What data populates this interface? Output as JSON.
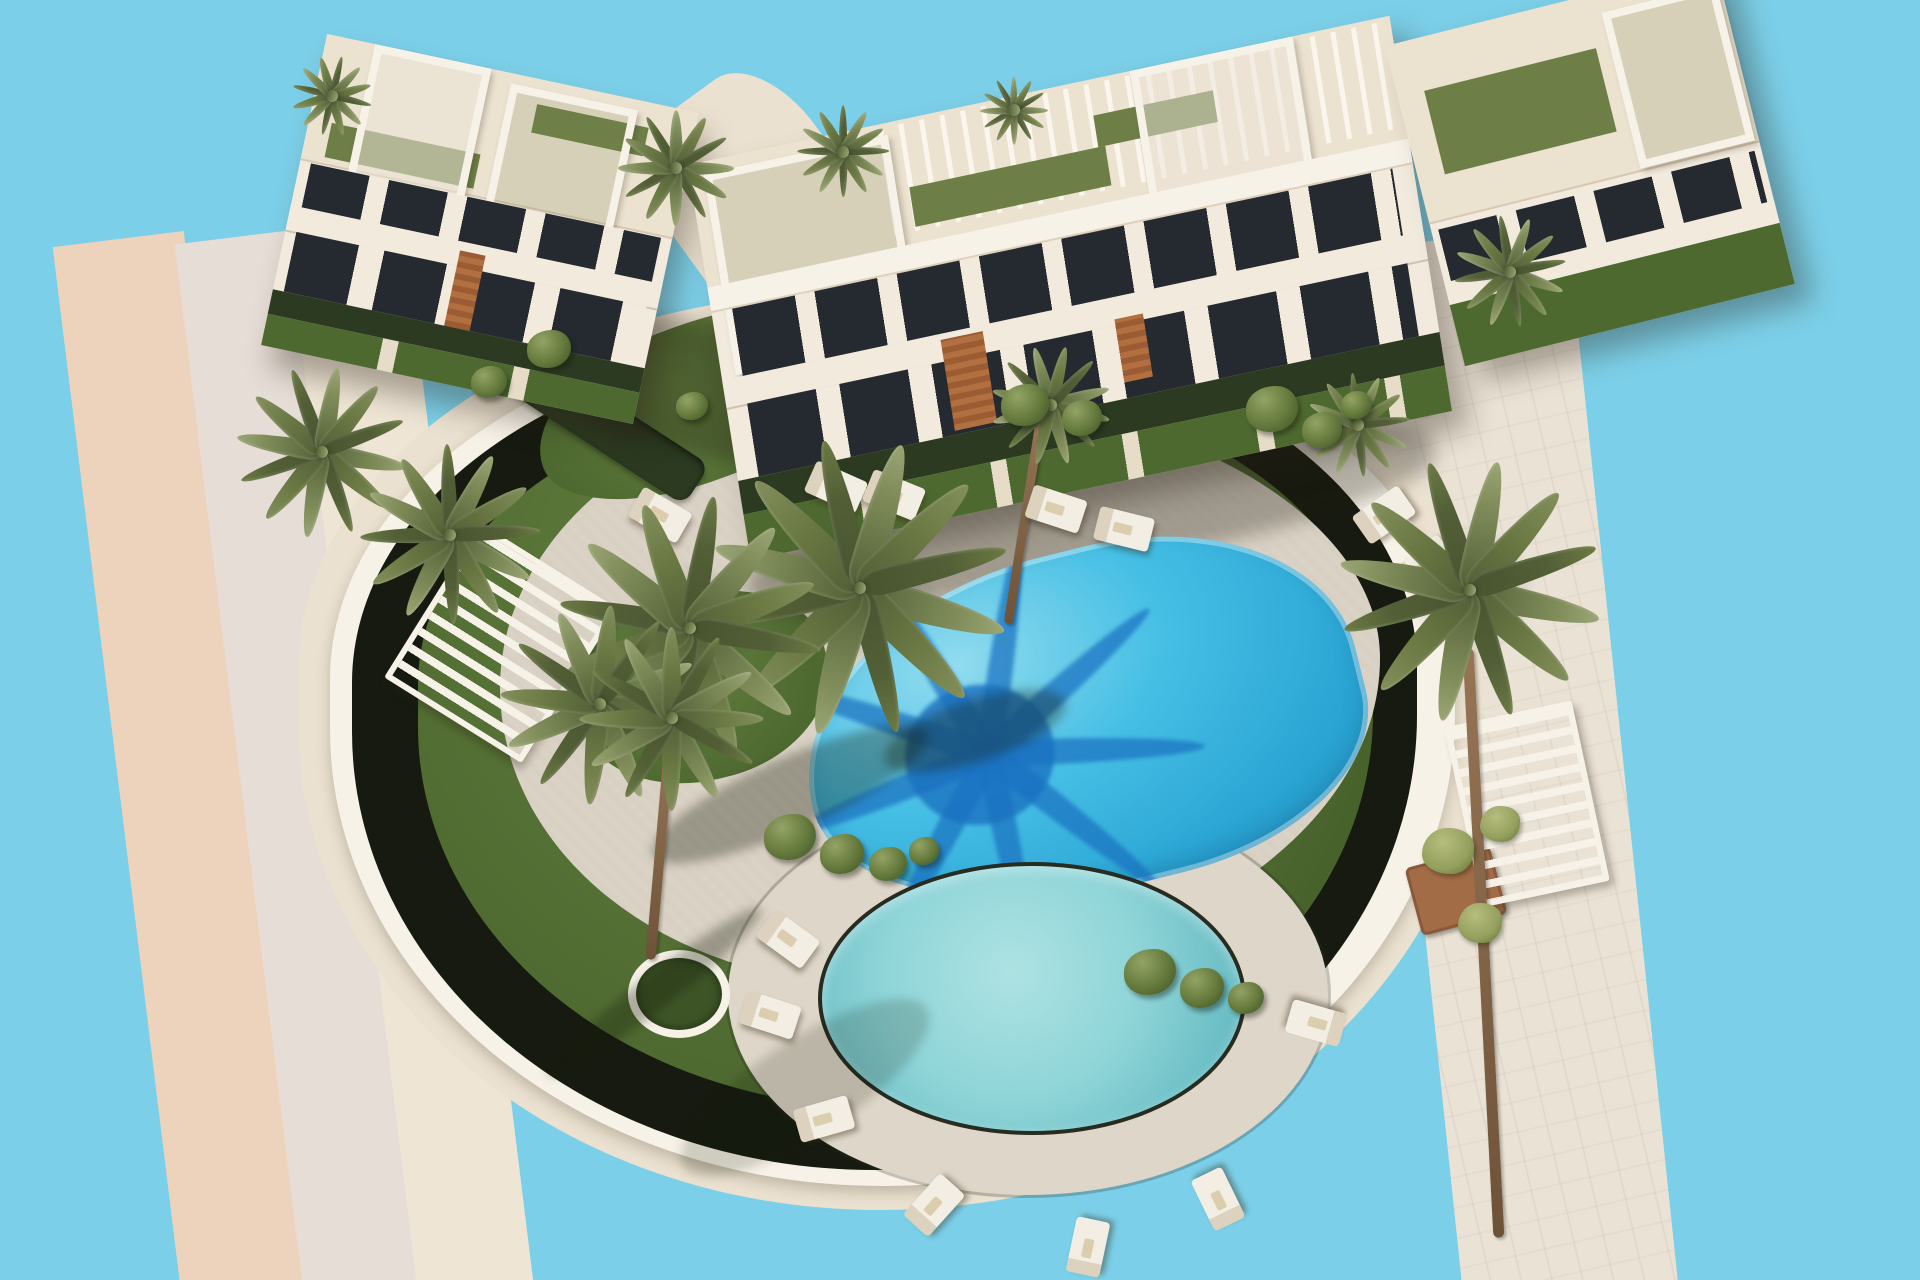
{
  "meta": {
    "width": 1920,
    "height": 1280,
    "alt": "Aerial 3D architectural rendering of a modern white residential complex with two swimming pools, palm trees, lawns, sun loungers and surrounding roads on a plain sky-blue background"
  },
  "palette": {
    "sky": "#7ccfe8",
    "roadPink": "#eed3bc",
    "roadGray": "#e6ddd6",
    "roadCream": "#eee5d5",
    "roadStone": "#eae2d5",
    "apron": "#ebe1d0",
    "wall": "#f7f2e8",
    "hedge": "#161a10",
    "lawnA": "#64803f",
    "lawnB": "#4e6930",
    "lawnC": "#3d5526",
    "deck": "#d8d0c2",
    "deckLight": "#ded6c8",
    "waterALight": "#93dcee",
    "waterA": "#46bfe5",
    "waterADeep": "#2aa5d4",
    "waterShadow": "#1a72c0",
    "waterBLight": "#aee2e3",
    "waterB": "#8fd5d8",
    "waterBDeep": "#68bcc4",
    "coping": "#272b20",
    "trunk": "#967555",
    "frondA": "#6b7944",
    "frondB": "#828f5c",
    "frondC": "#525f36",
    "lounger": "#f3eee3",
    "loungerEdge": "#ddd2bd",
    "wood": "#b26f3f",
    "facade": "#f1eadd",
    "roofSlab": "#ece2d0",
    "windowDark": "#242a30",
    "turf": "#6d7f46",
    "hedgeRow": "#2b3a21",
    "planter": "#a26c46"
  },
  "scene": {
    "items": [
      {
        "t": "roadright",
        "n": "road-right",
        "x": 1408,
        "y": 235,
        "w": 215,
        "h": 1060,
        "r": -6
      },
      {
        "t": "roadpink",
        "n": "road-left-asphalt",
        "x": 118,
        "y": 235,
        "w": 132,
        "h": 1080,
        "r": -7
      },
      {
        "t": "roadgray",
        "n": "road-left-sidewalk",
        "x": 240,
        "y": 233,
        "w": 122,
        "h": 1080,
        "r": -7
      },
      {
        "t": "roadcream",
        "n": "road-left-curb",
        "x": 354,
        "y": 230,
        "w": 116,
        "h": 1080,
        "r": -7
      },
      {
        "t": "walk",
        "n": "walkway-between-buildings",
        "x": 620,
        "y": 140,
        "w": 320,
        "h": 180,
        "r": 54
      },
      {
        "t": "apron",
        "n": "site-apron",
        "x": 298,
        "y": 292,
        "w": 1185,
        "h": 918
      },
      {
        "t": "wallring",
        "n": "perimeter-wall",
        "x": 330,
        "y": 324,
        "w": 1125,
        "h": 862
      },
      {
        "t": "hedgering",
        "n": "perimeter-hedge",
        "x": 352,
        "y": 342,
        "w": 1065,
        "h": 828
      },
      {
        "t": "lawnring",
        "n": "lawn",
        "x": 418,
        "y": 388,
        "w": 955,
        "h": 720
      },
      {
        "t": "deckblob",
        "n": "pool-deck",
        "x": 500,
        "y": 392,
        "w": 880,
        "h": 592
      },
      {
        "t": "lawnpatch",
        "n": "garden-top-left",
        "x": 530,
        "y": 322,
        "w": 345,
        "h": 158,
        "r": -21
      },
      {
        "t": "lawnpatch",
        "n": "garden-top-right",
        "x": 950,
        "y": 300,
        "w": 480,
        "h": 150,
        "r": -8
      },
      {
        "t": "lawnpatch",
        "n": "garden-center-left",
        "x": 575,
        "y": 592,
        "w": 255,
        "h": 188,
        "r": -14
      },
      {
        "t": "hedgerow",
        "n": "hedge-row-top",
        "x": 968,
        "y": 352,
        "w": 470,
        "h": 30,
        "r": 8
      },
      {
        "t": "hedgerow",
        "n": "hedge-row-left",
        "x": 490,
        "y": 400,
        "w": 225,
        "h": 48,
        "r": 33
      },
      {
        "t": "deck2",
        "n": "round-pool-deck",
        "x": 728,
        "y": 795,
        "w": 600,
        "h": 400
      },
      {
        "t": "island",
        "n": "palm-planter-island",
        "x": 628,
        "y": 950,
        "w": 86,
        "h": 72
      },
      {
        "t": "gate",
        "n": "garden-gate",
        "x": 864,
        "y": 390,
        "w": 58,
        "h": 60,
        "r": -12
      },
      {
        "t": "bshadow",
        "n": "building-left-shadow",
        "x": 560,
        "y": 330,
        "w": 340,
        "h": 130,
        "r": 12
      },
      {
        "t": "bshadow",
        "n": "building-right-shadow",
        "x": 740,
        "y": 470,
        "w": 700,
        "h": 100,
        "r": -12
      },
      {
        "t": "bldg-left",
        "n": "building-left",
        "x": 290,
        "y": 70,
        "w": 380,
        "h": 318,
        "tr": "rotate(12deg)"
      },
      {
        "t": "bldg-right",
        "n": "building-right",
        "x": 712,
        "y": 88,
        "w": 716,
        "h": 400,
        "tr": "rotate(-9deg) skewY(-3deg)"
      },
      {
        "t": "bldg-annex",
        "n": "building-right-wing",
        "x": 1420,
        "y": 0,
        "w": 340,
        "h": 330,
        "tr": "rotate(-14deg)"
      },
      {
        "t": "poolA",
        "n": "main-pool",
        "x": 800,
        "y": 552,
        "w": 565,
        "h": 340,
        "r": -14
      },
      {
        "t": "poolB",
        "n": "round-pool",
        "x": 818,
        "y": 862,
        "w": 420,
        "h": 265
      },
      {
        "t": "planter",
        "n": "planter-bottom-right",
        "x": 1412,
        "y": 856,
        "w": 82,
        "h": 64,
        "r": -15
      },
      {
        "t": "pergola",
        "n": "pergola-left",
        "x": 420,
        "y": 552,
        "w": 150,
        "h": 170,
        "r": 32
      },
      {
        "t": "pergola",
        "n": "pergola-right",
        "x": 1462,
        "y": 712,
        "w": 118,
        "h": 172,
        "r": -12
      },
      {
        "t": "pshadow",
        "n": "palm-shadow-deck-left",
        "x": 640,
        "y": 758,
        "w": 300,
        "h": 72,
        "r": -24
      },
      {
        "t": "pshadow",
        "n": "palm-shadow-pool-edge",
        "x": 880,
        "y": 700,
        "w": 190,
        "h": 62,
        "r": -18
      },
      {
        "t": "pshadow",
        "n": "palm-shadow-island",
        "x": 520,
        "y": 975,
        "w": 270,
        "h": 34,
        "r": -38
      },
      {
        "t": "pshadow",
        "n": "tree-shadow-lawn",
        "x": 660,
        "y": 1040,
        "w": 290,
        "h": 95,
        "r": -33,
        "o": 0.55
      },
      {
        "t": "trunk",
        "n": "palm-trunk-island",
        "x": 655,
        "y": 742,
        "w": 10,
        "h": 218,
        "r": 5
      },
      {
        "t": "trunk",
        "n": "palm-trunk-right",
        "x": 1478,
        "y": 648,
        "w": 11,
        "h": 590,
        "r": -3
      },
      {
        "t": "trunk",
        "n": "palm-trunk-center",
        "x": 1020,
        "y": 415,
        "w": 9,
        "h": 210,
        "r": 9
      },
      {
        "t": "lounger",
        "n": "sun-lounger",
        "x": 808,
        "y": 470,
        "w": 56,
        "h": 34,
        "r": 24
      },
      {
        "t": "lounger",
        "n": "sun-lounger",
        "x": 866,
        "y": 478,
        "w": 56,
        "h": 34,
        "r": 22
      },
      {
        "t": "lounger",
        "n": "sun-lounger",
        "x": 1028,
        "y": 492,
        "w": 56,
        "h": 34,
        "r": 18
      },
      {
        "t": "lounger",
        "n": "sun-lounger",
        "x": 1096,
        "y": 512,
        "w": 56,
        "h": 34,
        "r": 14
      },
      {
        "t": "lounger",
        "n": "sun-lounger",
        "x": 1356,
        "y": 498,
        "w": 56,
        "h": 34,
        "r": -35
      },
      {
        "t": "lounger",
        "n": "sun-lounger",
        "x": 1398,
        "y": 548,
        "w": 56,
        "h": 34,
        "r": -40
      },
      {
        "t": "lounger",
        "n": "sun-lounger",
        "x": 632,
        "y": 498,
        "w": 56,
        "h": 34,
        "r": 30
      },
      {
        "t": "lounger",
        "n": "sun-lounger",
        "x": 760,
        "y": 922,
        "w": 56,
        "h": 34,
        "r": 36
      },
      {
        "t": "lounger",
        "n": "sun-lounger",
        "x": 742,
        "y": 998,
        "w": 56,
        "h": 34,
        "r": 18
      },
      {
        "t": "lounger",
        "n": "sun-lounger",
        "x": 796,
        "y": 1102,
        "w": 56,
        "h": 34,
        "r": -16
      },
      {
        "t": "lounger",
        "n": "sun-lounger",
        "x": 906,
        "y": 1188,
        "w": 56,
        "h": 34,
        "r": -48
      },
      {
        "t": "lounger",
        "n": "sun-lounger",
        "x": 1060,
        "y": 1230,
        "w": 56,
        "h": 34,
        "r": -78
      },
      {
        "t": "lounger",
        "n": "sun-lounger",
        "x": 1190,
        "y": 1182,
        "w": 56,
        "h": 34,
        "r": -116
      },
      {
        "t": "lounger",
        "n": "sun-lounger",
        "x": 1288,
        "y": 1006,
        "w": 56,
        "h": 34,
        "r": -164
      },
      {
        "t": "palm",
        "n": "palm-tree",
        "x": 676,
        "y": 168,
        "s": 58
      },
      {
        "t": "palm",
        "n": "palm-tree",
        "x": 843,
        "y": 152,
        "s": 46,
        "r": 15
      },
      {
        "t": "palm",
        "n": "palm-tree",
        "x": 1014,
        "y": 110,
        "s": 34
      },
      {
        "t": "palm",
        "n": "palm-tree",
        "x": 332,
        "y": 96,
        "s": 40,
        "r": 22
      },
      {
        "t": "palm",
        "n": "palm-tree",
        "x": 1510,
        "y": 272,
        "s": 56,
        "r": 10
      },
      {
        "t": "palm",
        "n": "palm-tree-over-pool",
        "x": 860,
        "y": 588,
        "s": 150,
        "r": 8
      },
      {
        "t": "palm",
        "n": "palm-tree",
        "x": 690,
        "y": 628,
        "s": 132,
        "r": 20
      },
      {
        "t": "palm",
        "n": "palm-tree",
        "x": 600,
        "y": 704,
        "s": 100,
        "r": -12
      },
      {
        "t": "palm",
        "n": "palm-tree-island",
        "x": 672,
        "y": 718,
        "s": 92,
        "r": 30
      },
      {
        "t": "palm",
        "n": "palm-tree",
        "x": 322,
        "y": 452,
        "s": 86,
        "r": 5
      },
      {
        "t": "palm",
        "n": "palm-tree",
        "x": 450,
        "y": 535,
        "s": 90,
        "r": 14
      },
      {
        "t": "palm",
        "n": "palm-tree-right",
        "x": 1470,
        "y": 590,
        "s": 132,
        "r": 6
      },
      {
        "t": "palm",
        "n": "palm-tree",
        "x": 1051,
        "y": 405,
        "s": 60,
        "r": -8
      },
      {
        "t": "palm",
        "n": "palm-tree",
        "x": 1358,
        "y": 425,
        "s": 52,
        "r": 12
      },
      {
        "t": "bush",
        "n": "shrub",
        "x": 764,
        "y": 814,
        "w": 52,
        "h": 46
      },
      {
        "t": "bush",
        "n": "shrub",
        "x": 820,
        "y": 834,
        "w": 44,
        "h": 40
      },
      {
        "t": "bush",
        "n": "shrub",
        "x": 869,
        "y": 847,
        "w": 38,
        "h": 34
      },
      {
        "t": "bush",
        "n": "shrub",
        "x": 909,
        "y": 837,
        "w": 30,
        "h": 28
      },
      {
        "t": "bush",
        "n": "shrub",
        "x": 1124,
        "y": 949,
        "w": 52,
        "h": 46
      },
      {
        "t": "bush",
        "n": "shrub",
        "x": 1180,
        "y": 968,
        "w": 44,
        "h": 40
      },
      {
        "t": "bush",
        "n": "shrub",
        "x": 1228,
        "y": 982,
        "w": 36,
        "h": 32
      },
      {
        "t": "bush",
        "n": "shrub",
        "x": 1001,
        "y": 384,
        "w": 48,
        "h": 42
      },
      {
        "t": "bush",
        "n": "shrub",
        "x": 1062,
        "y": 400,
        "w": 40,
        "h": 36
      },
      {
        "t": "bush",
        "n": "shrub",
        "x": 1246,
        "y": 386,
        "w": 52,
        "h": 46
      },
      {
        "t": "bush",
        "n": "shrub",
        "x": 1302,
        "y": 412,
        "w": 40,
        "h": 36
      },
      {
        "t": "bush",
        "n": "shrub",
        "x": 1341,
        "y": 391,
        "w": 30,
        "h": 28
      },
      {
        "t": "bush",
        "n": "shrub",
        "x": 527,
        "y": 330,
        "w": 44,
        "h": 38
      },
      {
        "t": "bush",
        "n": "shrub",
        "x": 471,
        "y": 366,
        "w": 36,
        "h": 32
      },
      {
        "t": "bush",
        "n": "shrub",
        "x": 676,
        "y": 392,
        "w": 32,
        "h": 28
      },
      {
        "t": "tuft",
        "n": "grass-tuft",
        "x": 1422,
        "y": 828,
        "w": 52,
        "h": 46
      },
      {
        "t": "tuft",
        "n": "grass-tuft",
        "x": 1480,
        "y": 806,
        "w": 40,
        "h": 36
      },
      {
        "t": "tuft",
        "n": "grass-tuft",
        "x": 1458,
        "y": 903,
        "w": 44,
        "h": 40
      }
    ]
  }
}
